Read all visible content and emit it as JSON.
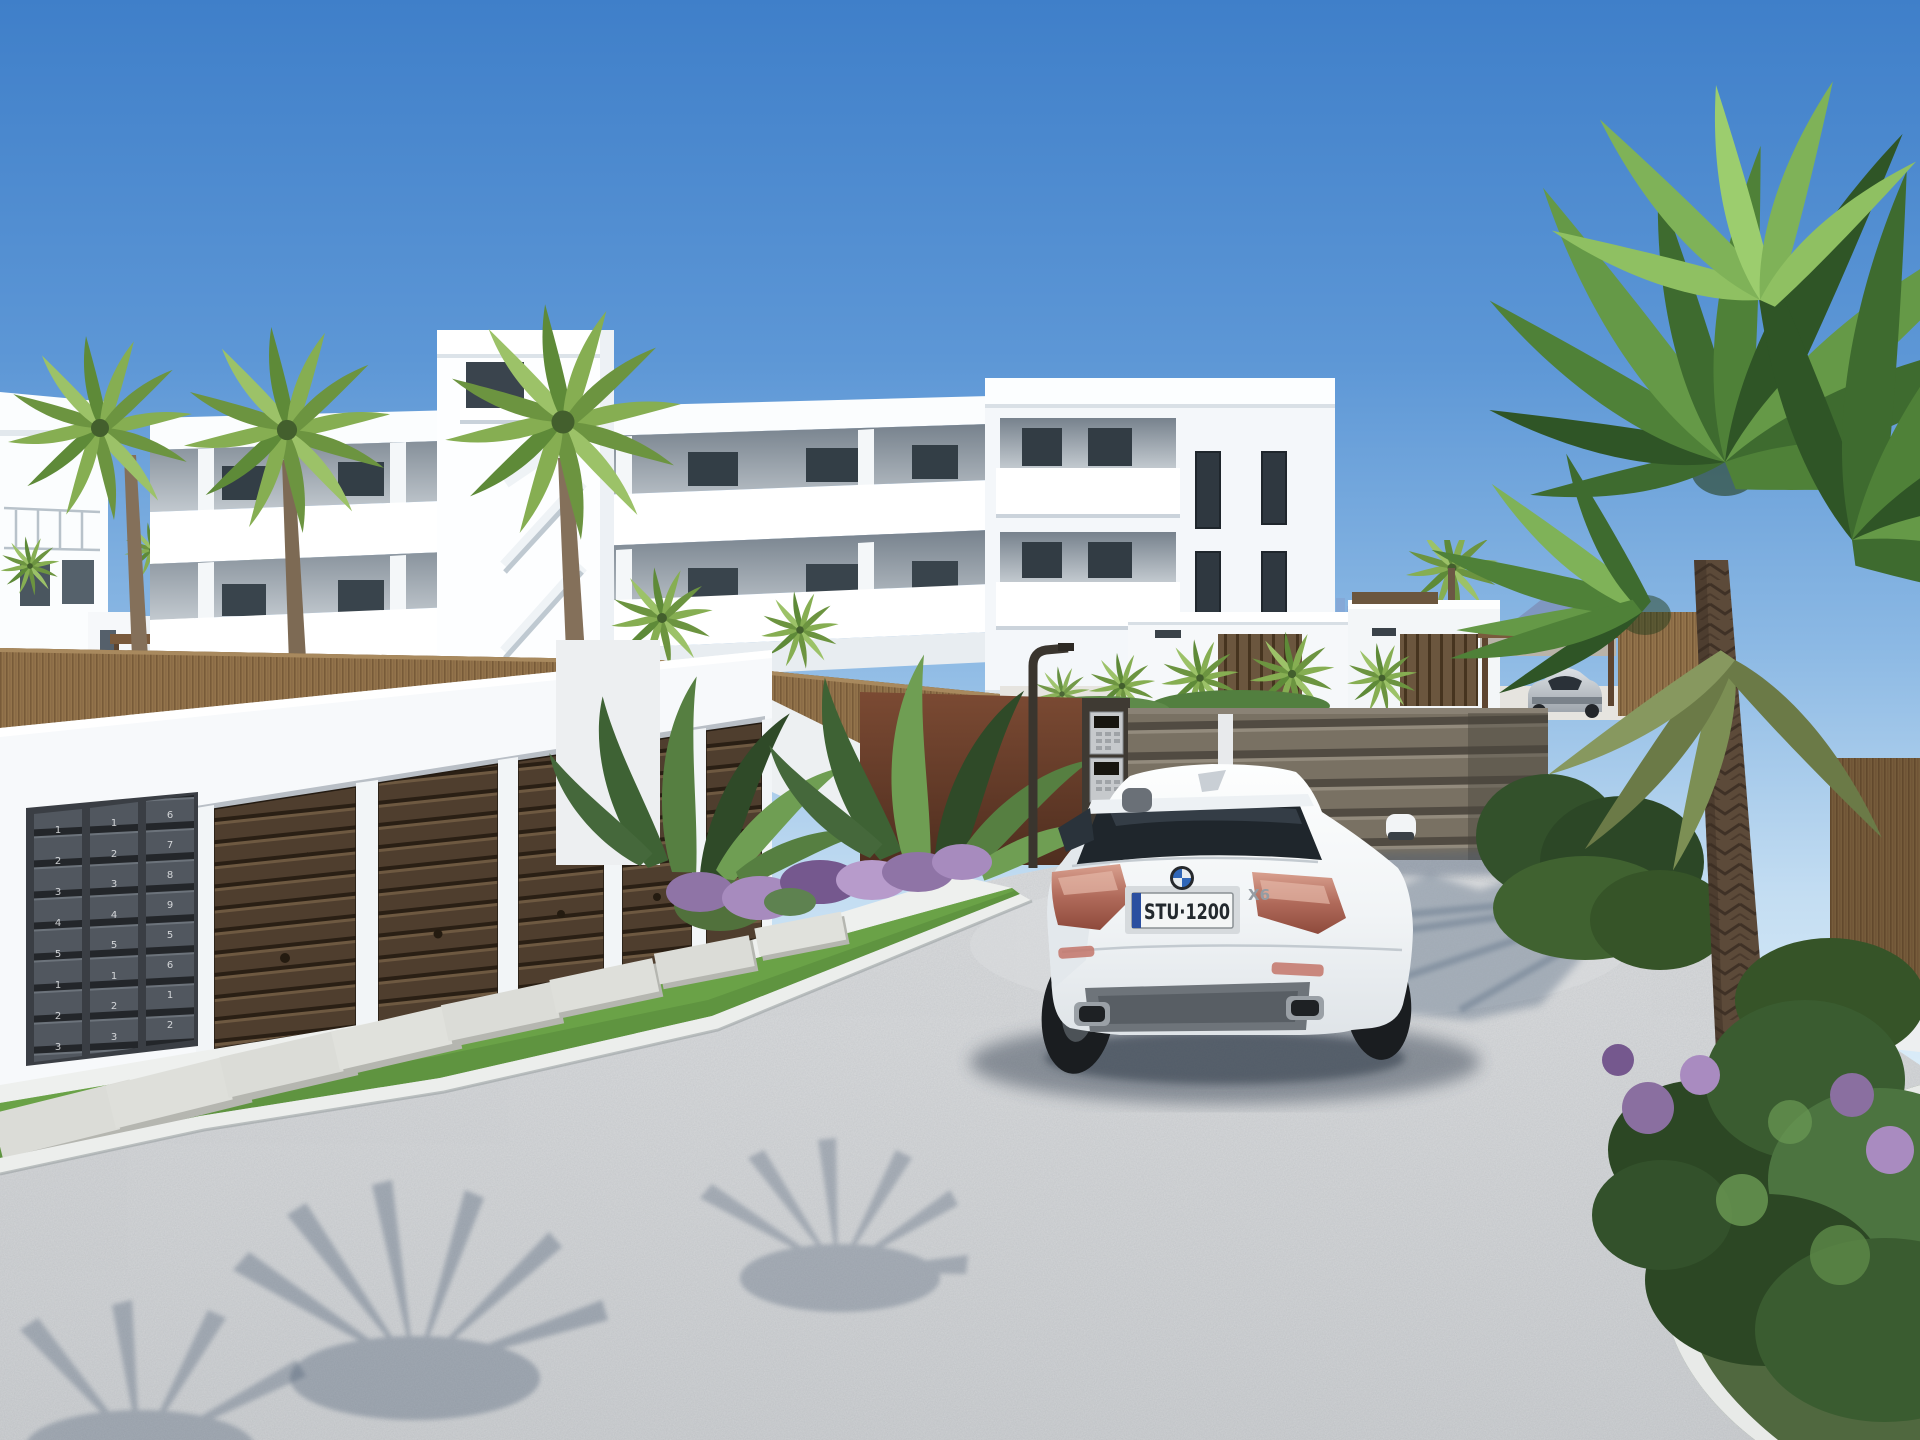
{
  "meta": {
    "title": "New-build residential complex exterior 3D render",
    "scene_type": "architectural visualization, daylight"
  },
  "car": {
    "make_icon": "bmw-roundel",
    "model_badge": "X6",
    "license_plate": "STU·1200",
    "plate_band_color": "#2B4FA0",
    "body_color": "#F3F5F6"
  },
  "background_car": {
    "body_color": "#C9CED3"
  },
  "mailboxes": {
    "columns": [
      {
        "numbers": [
          "1",
          "2",
          "3",
          "4",
          "5",
          "1",
          "2",
          "3"
        ]
      },
      {
        "numbers": [
          "1",
          "2",
          "3",
          "4",
          "5",
          "1",
          "2",
          "3"
        ]
      },
      {
        "numbers": [
          "6",
          "7",
          "8",
          "9",
          "5",
          "6",
          "1",
          "2"
        ]
      }
    ]
  },
  "palette": {
    "sky_top": "#3F7FC9",
    "sky_horizon": "#E2F1FA",
    "building_white": "#FFFFFF",
    "reed_fence": "#8B6E47",
    "garage_door": "#4F3E2E",
    "gate": "#797163",
    "grass": "#5F9440",
    "asphalt": "#CBCED1",
    "mountain": "#7E96BF",
    "palm_green": "#4F8138",
    "corten_wall": "#7B4A33"
  },
  "scene_elements": [
    "apartment-building",
    "stair-tower",
    "palm-trees",
    "reed-fence",
    "garage-block",
    "garage-doors",
    "mailbox-panel",
    "stepping-stones",
    "grass-strip",
    "flower-bed",
    "driveway",
    "entrance-gate",
    "intercom-post",
    "street-lamp",
    "bmw-x6-car",
    "background-sports-car",
    "background-villas",
    "pergola",
    "mountain",
    "large-palm-tree",
    "planting-bed"
  ]
}
